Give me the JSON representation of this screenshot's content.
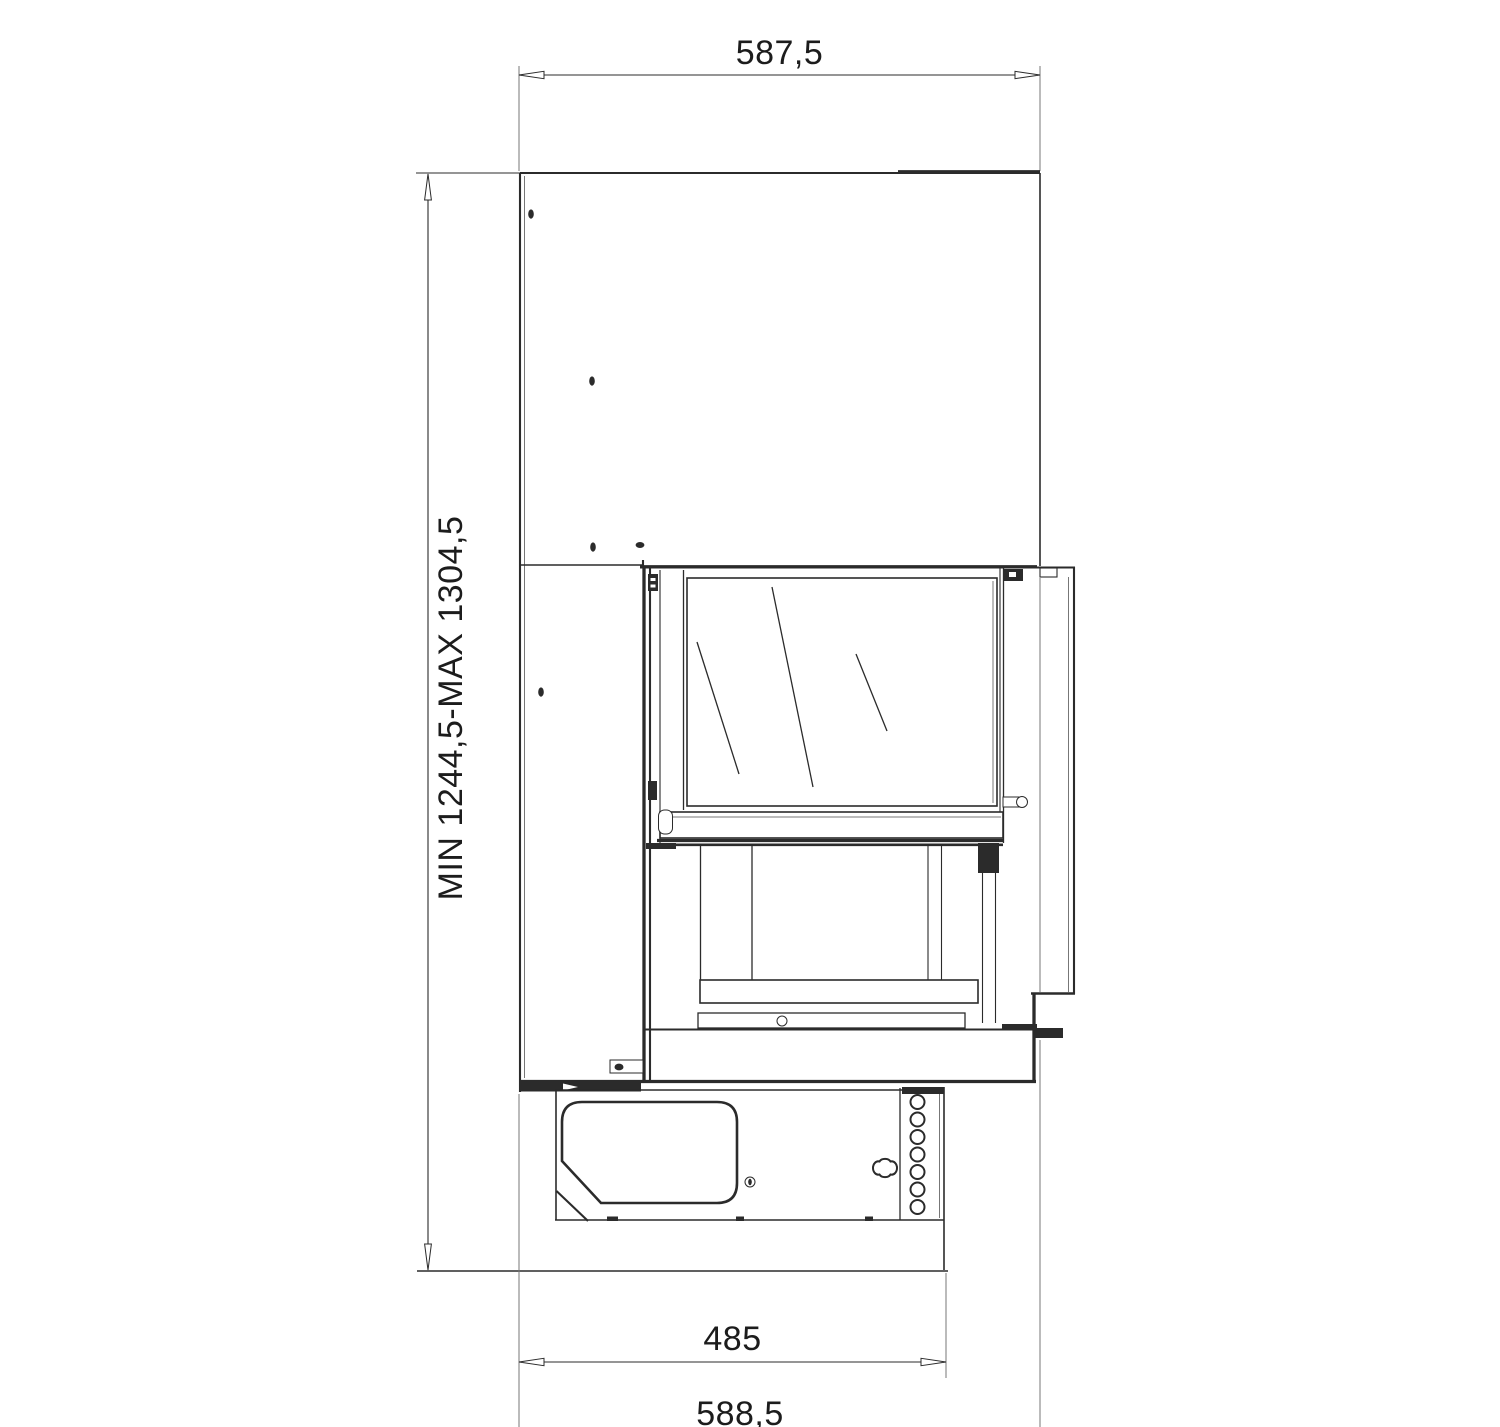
{
  "drawing": {
    "dimension_labels": {
      "top_width": "587,5",
      "height_range": "MIN 1244,5-MAX 1304,5",
      "base_width": "485",
      "bottom_width": "588,5"
    },
    "colors": {
      "background": "#ffffff",
      "line": "#2b2b2b",
      "thin_line": "#777777",
      "text": "#1c1c1c"
    }
  }
}
